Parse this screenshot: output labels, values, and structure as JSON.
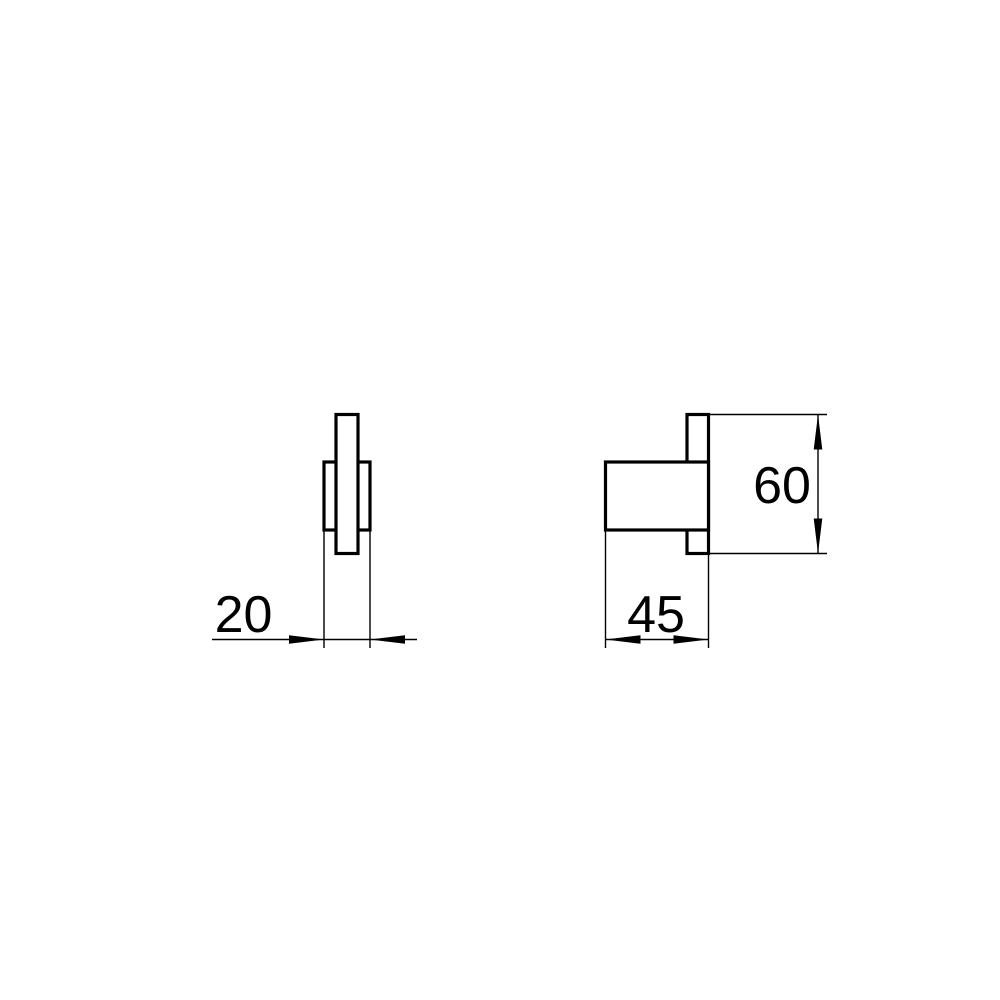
{
  "drawing": {
    "background_color": "#ffffff",
    "line_color": "#000000",
    "views": {
      "front": {
        "features": [
          "plate",
          "band"
        ]
      },
      "side": {
        "features": [
          "body",
          "flange"
        ]
      }
    }
  },
  "dimensions": {
    "front_width": {
      "label": "20"
    },
    "side_width": {
      "label": "45"
    },
    "side_height": {
      "label": "60"
    }
  }
}
